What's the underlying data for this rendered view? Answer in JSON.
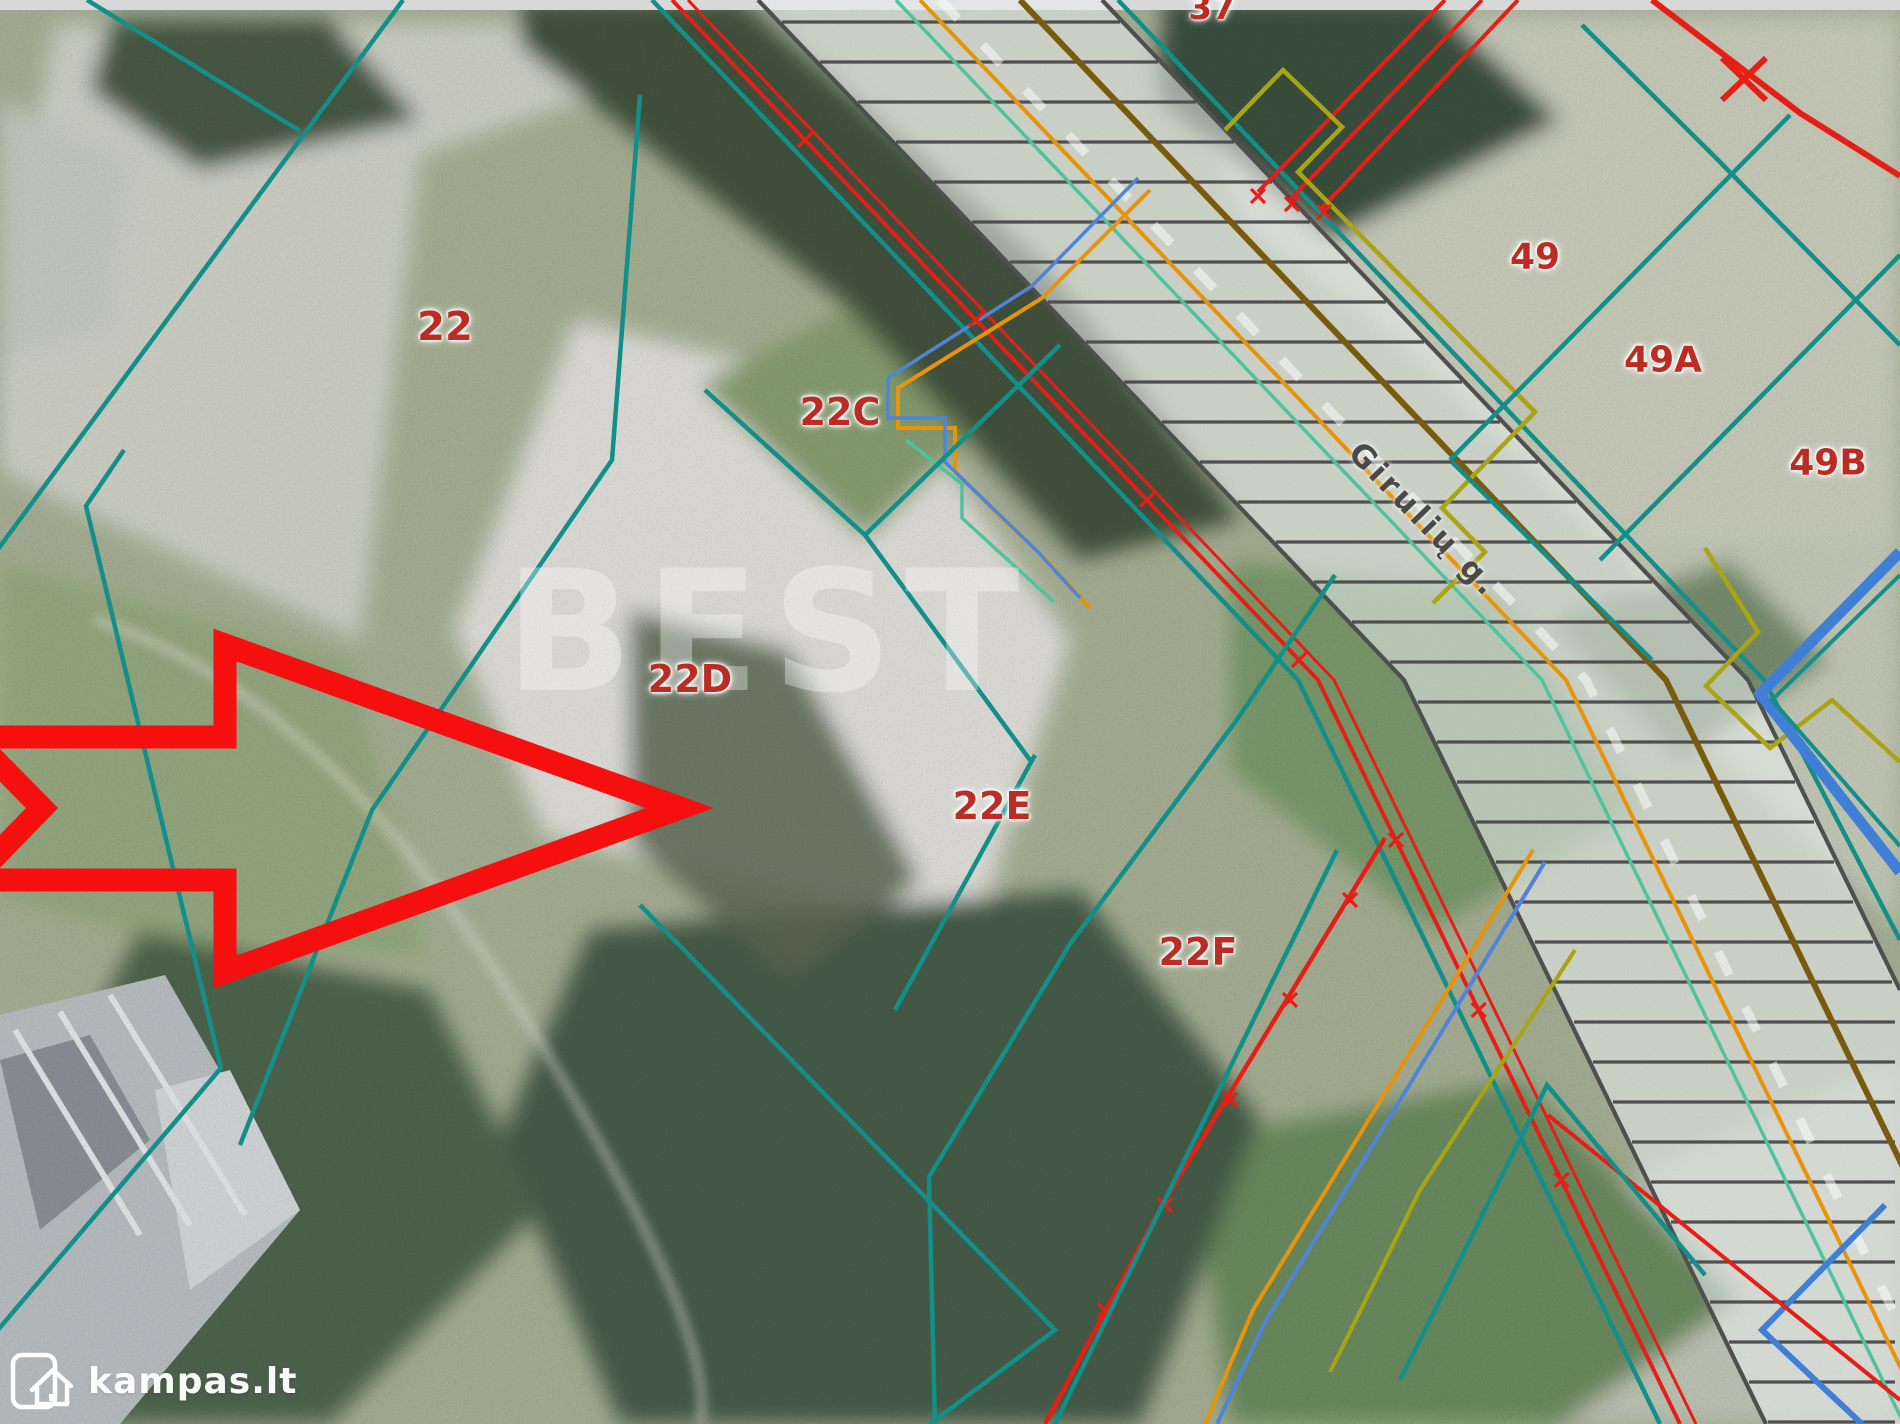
{
  "map": {
    "watermark_text": "BEST",
    "street_label": {
      "text": "Girulių g.",
      "x": 1424,
      "y": 520,
      "rotation_deg": 46
    },
    "parcel_labels": [
      {
        "id": "37",
        "text": "37",
        "x": 1212,
        "y": 8,
        "size": 34
      },
      {
        "id": "22",
        "text": "22",
        "x": 445,
        "y": 327,
        "size": 40
      },
      {
        "id": "22C",
        "text": "22C",
        "x": 840,
        "y": 412,
        "size": 38
      },
      {
        "id": "22D",
        "text": "22D",
        "x": 690,
        "y": 679,
        "size": 38
      },
      {
        "id": "22E",
        "text": "22E",
        "x": 992,
        "y": 806,
        "size": 38
      },
      {
        "id": "22F",
        "text": "22F",
        "x": 1198,
        "y": 952,
        "size": 38
      },
      {
        "id": "49",
        "text": "49",
        "x": 1535,
        "y": 257,
        "size": 36
      },
      {
        "id": "49A",
        "text": "49A",
        "x": 1663,
        "y": 360,
        "size": 36
      },
      {
        "id": "49B",
        "text": "49B",
        "x": 1828,
        "y": 463,
        "size": 36
      }
    ],
    "colors": {
      "parcel_boundary_teal": "#128f89",
      "label_red": "#bb2d24",
      "arrow_red": "#f60f0f",
      "utility_red": "#e51f16",
      "utility_orange": "#e8940a",
      "utility_blue": "#3f7fd6",
      "utility_olive": "#a9a414",
      "utility_brown": "#7a5a0d",
      "utility_mint": "#4fc39f",
      "road_rail_gray": "#4f4f4f",
      "street_text_gray": "#4a4a4a"
    }
  },
  "branding": {
    "site_name": "kampas.lt"
  }
}
